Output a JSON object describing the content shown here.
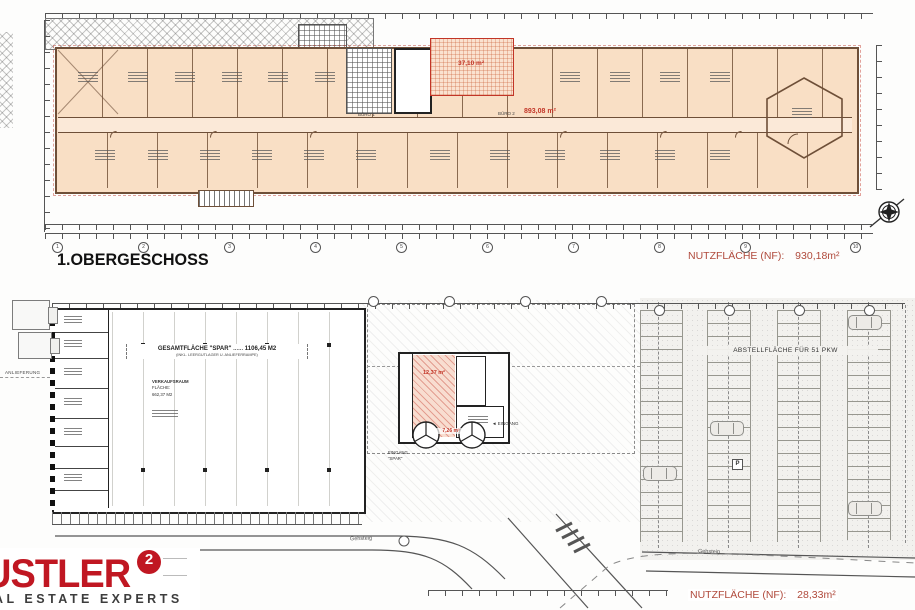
{
  "colors": {
    "accent_red": "#b04a3c",
    "plan_red": "#c23527",
    "logo_red": "#c01722",
    "room_fill": "#f9dfc5",
    "plan_line": "#6e4f38"
  },
  "upper_plan": {
    "title": "1.OBERGESCHOSS",
    "nutzflaeche_label": "NUTZFLÄCHE (NF):",
    "nutzflaeche_value": "930,18m²",
    "buero1_label": "BÜRO 1",
    "buero2_label": "BÜRO 2",
    "stair_area_value": "37,10 m²",
    "office_area_value": "893,08 m²",
    "grid_bubbles": [
      "1",
      "2",
      "3",
      "4",
      "5",
      "6",
      "7",
      "8",
      "9",
      "10"
    ]
  },
  "lower_plan": {
    "spar_total_label": "GESAMTFLÄCHE \"SPAR\"",
    "spar_total_leader": "......",
    "spar_total_value": "1106,45 M2",
    "spar_total_note": "(INKL. LEERGUTLAGER U. ANLIEFERRAMPE)",
    "verkaufsraum_label": "VERKAUFSRAUM",
    "verkaufsraum_sublabel": "FLÄCHE:",
    "verkaufsraum_value": "662,37 M2",
    "anlieferung_label": "ANLIEFERUNG",
    "parking_label": "ABSTELLFLÄCHE FÜR 51 PKW",
    "parking_sign": "P",
    "lobby_area_value": "12,37 m²",
    "entry_area_value": "7,26 m²",
    "entrance_right_label": "◄ EINGANG",
    "entrance_bottom_label_1": "EINGANG",
    "entrance_bottom_label_2": "\"SPAR\"",
    "sidewalk_label_left": "Gehsteig",
    "sidewalk_label_right": "Gehsteig",
    "nutzflaeche_label": "NUTZFLÄCHE (NF):",
    "nutzflaeche_value": "28,33m²"
  },
  "branding": {
    "logo_text": "USTLER",
    "logo_sup": "2",
    "logo_subtitle": "AL ESTATE EXPERTS"
  }
}
